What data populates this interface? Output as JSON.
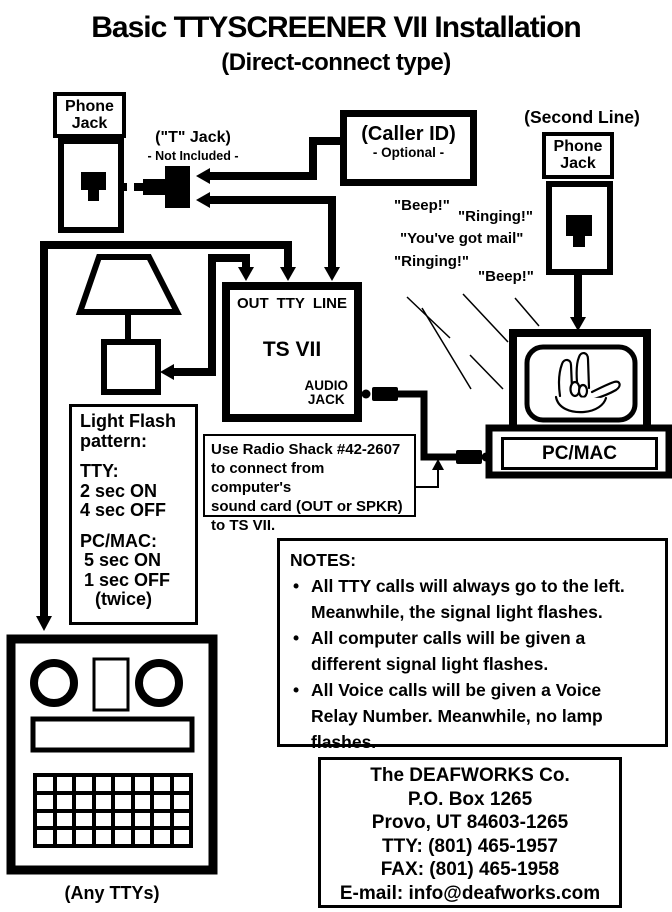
{
  "page": {
    "title": "Basic TTYSCREENER VII Installation",
    "subtitle": "(Direct-connect type)"
  },
  "left_jack": {
    "label": "Phone\nJack"
  },
  "t_jack": {
    "label": "(\"T\" Jack)",
    "note": "- Not Included -"
  },
  "caller_id": {
    "label": "(Caller ID)",
    "note": "- Optional -"
  },
  "second_line": {
    "label": "(Second Line)",
    "jack_label": "Phone\nJack"
  },
  "sounds": [
    "\"Beep!\"",
    "\"Ringing!\"",
    "\"You've got mail\"",
    "\"Ringing!\"",
    "\"Beep!\""
  ],
  "ts_vii": {
    "ports": [
      "OUT",
      "TTY",
      "LINE"
    ],
    "name": "TS VII",
    "audio_jack": "AUDIO\nJACK"
  },
  "light_flash": {
    "heading": "Light Flash\npattern:",
    "tty_label": "TTY:",
    "tty_on": "2 sec ON",
    "tty_off": "4 sec OFF",
    "pc_label": "PC/MAC:",
    "pc_on": "5 sec ON",
    "pc_off": "1 sec OFF",
    "pc_twice": "(twice)"
  },
  "radio_shack": {
    "note": "Use Radio Shack #42-2607\nto connect from computer's\nsound card (OUT or SPKR)\nto TS VII."
  },
  "computer": {
    "label": "PC/MAC"
  },
  "notes": {
    "heading": "NOTES:",
    "items": [
      "All TTY calls will always go to the left.\nMeanwhile, the signal light flashes.",
      "All computer calls will be given a\ndifferent signal light flashes.",
      "All Voice calls will be given a Voice\nRelay Number.  Meanwhile, no lamp\nflashes."
    ]
  },
  "contact": {
    "company": "The DEAFWORKS Co.",
    "po_box": "P.O. Box 1265",
    "city": "Provo, UT  84603-1265",
    "tty": "TTY: (801) 465-1957",
    "fax": "FAX: (801) 465-1958",
    "email": "E-mail: info@deafworks.com"
  },
  "tty_device": {
    "caption": "(Any TTYs)"
  }
}
